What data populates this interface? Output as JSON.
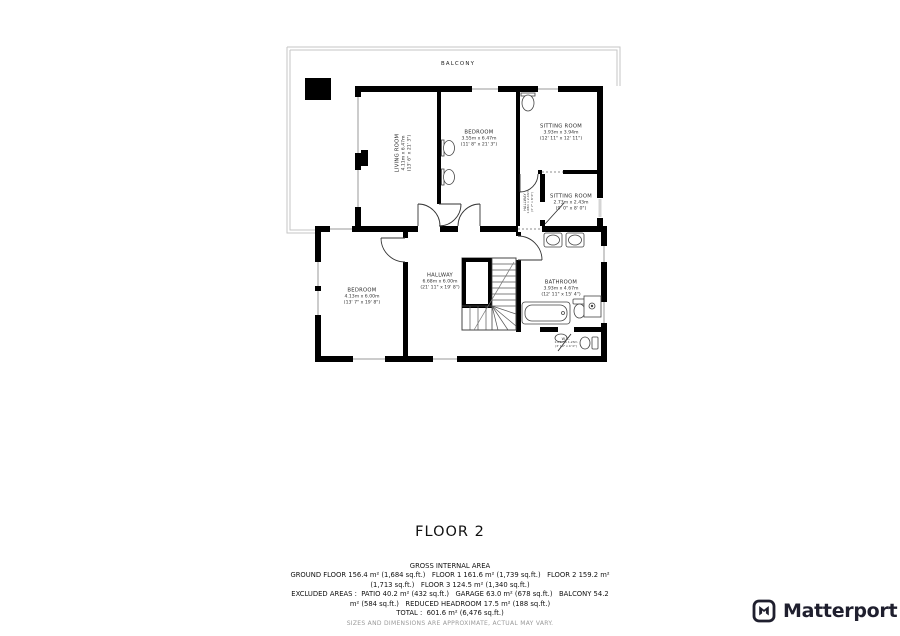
{
  "title": "FLOOR 2",
  "plan": {
    "balcony": "BALCONY",
    "rooms": [
      {
        "name": "LIVING ROOM",
        "metric": "4.11m x 6.47m",
        "imperial": "(13' 6\" x 21' 3\")"
      },
      {
        "name": "BEDROOM",
        "metric": "3.55m x 6.47m",
        "imperial": "(11' 8\" x 21' 3\")"
      },
      {
        "name": "SITTING ROOM",
        "metric": "3.93m x 3.94m",
        "imperial": "(12' 11\" x 12' 11\")"
      },
      {
        "name": "HALLWAY",
        "metric": "1.08m x 2.43m",
        "imperial": "(3' 7\" x 8' 0\")"
      },
      {
        "name": "SITTING ROOM",
        "metric": "2.73m x 2.43m",
        "imperial": "(9' 0\" x 8' 0\")"
      },
      {
        "name": "BEDROOM",
        "metric": "4.13m x 6.00m",
        "imperial": "(13' 7\" x 19' 8\")"
      },
      {
        "name": "HALLWAY",
        "metric": "6.68m x 6.00m",
        "imperial": "(21' 11\" x 19' 8\")"
      },
      {
        "name": "BATHROOM",
        "metric": "3.93m x 4.67m",
        "imperial": "(12' 11\" x 15' 4\")"
      },
      {
        "name": "W.C.",
        "metric": "1.09m x 1.23m",
        "imperial": "(3' 10\" x 4' 0\")"
      }
    ]
  },
  "footer": {
    "heading": "GROSS INTERNAL AREA",
    "lines": [
      "GROUND FLOOR 156.4 m² (1,684 sq.ft.)   FLOOR 1 161.6 m² (1,739 sq.ft.)   FLOOR 2 159.2 m²",
      "(1,713 sq.ft.)   FLOOR 3 124.5 m² (1,340 sq.ft.)",
      "EXCLUDED AREAS :  PATIO 40.2 m² (432 sq.ft.)   GARAGE 63.0 m² (678 sq.ft.)   BALCONY 54.2",
      "m² (584 sq.ft.)   REDUCED HEADROOM 17.5 m² (188 sq.ft.)",
      "TOTAL :  601.6 m² (6,476 sq.ft.)"
    ],
    "disclaimer": "SIZES AND DIMENSIONS ARE APPROXIMATE, ACTUAL MAY VARY."
  },
  "branding": {
    "name": "Matterport"
  },
  "colors": {
    "wall": "#000000",
    "balcony_rail": "#c6c6c6",
    "text": "#111111",
    "muted": "#9a9a9a",
    "logo": "#1f1f2e"
  }
}
